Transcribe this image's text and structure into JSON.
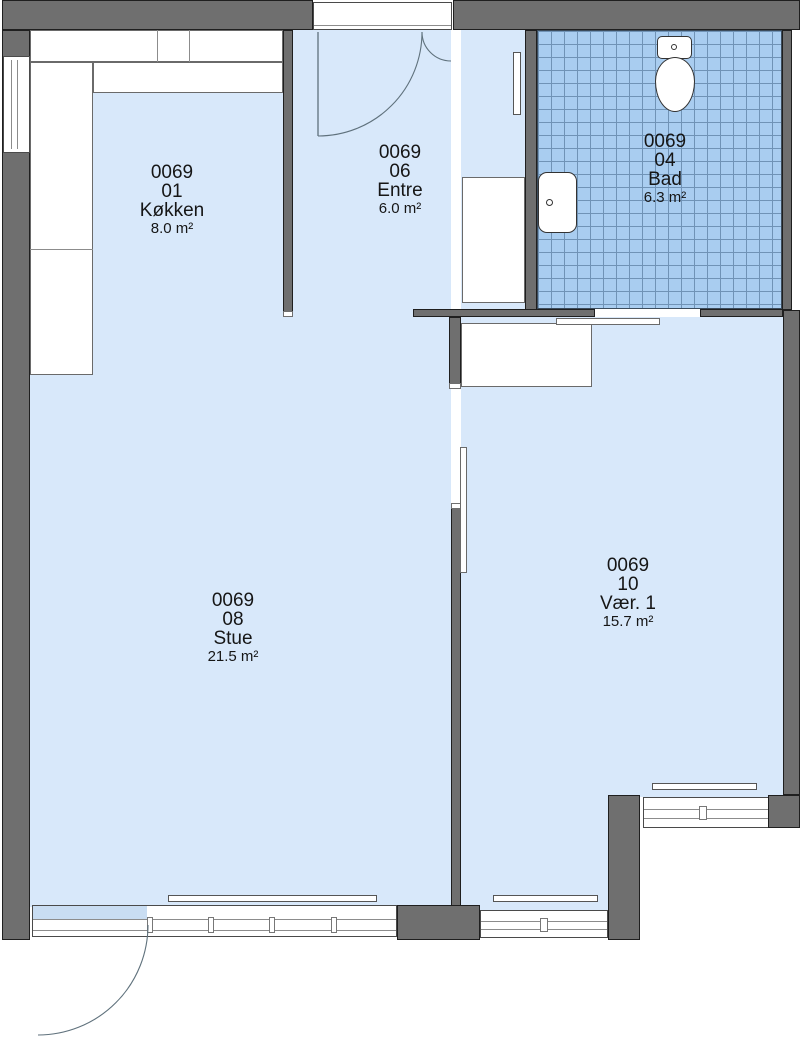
{
  "rooms": [
    {
      "code": "0069",
      "unit": "01",
      "name": "Køkken",
      "area": "8.0 m²"
    },
    {
      "code": "0069",
      "unit": "06",
      "name": "Entre",
      "area": "6.0 m²"
    },
    {
      "code": "0069",
      "unit": "04",
      "name": "Bad",
      "area": "6.3 m²"
    },
    {
      "code": "0069",
      "unit": "08",
      "name": "Stue",
      "area": "21.5 m²"
    },
    {
      "code": "0069",
      "unit": "10",
      "name": "Vær. 1",
      "area": "15.7 m²"
    }
  ],
  "fixtures": [
    "toilet",
    "sink",
    "kitchen-counter",
    "wardrobe-entre",
    "wardrobe-vaer",
    "radiator-entre",
    "radiator-stue",
    "radiator-vaer-south",
    "radiator-vaer-east",
    "entrance-door",
    "balcony-door",
    "sliding-door-bad",
    "sliding-door-vaer",
    "window-kitchen",
    "window-stue",
    "window-vaer-south",
    "window-vaer-east"
  ],
  "colors": {
    "wall": "#6f6f6f",
    "outline": "#1f1f1f",
    "room_fill": "#d8e8fa",
    "tile_fill": "#a9cdf0",
    "tile_line": "#7093b6",
    "glass_tint": "#c9ddf2",
    "arc": "#5f717c"
  }
}
